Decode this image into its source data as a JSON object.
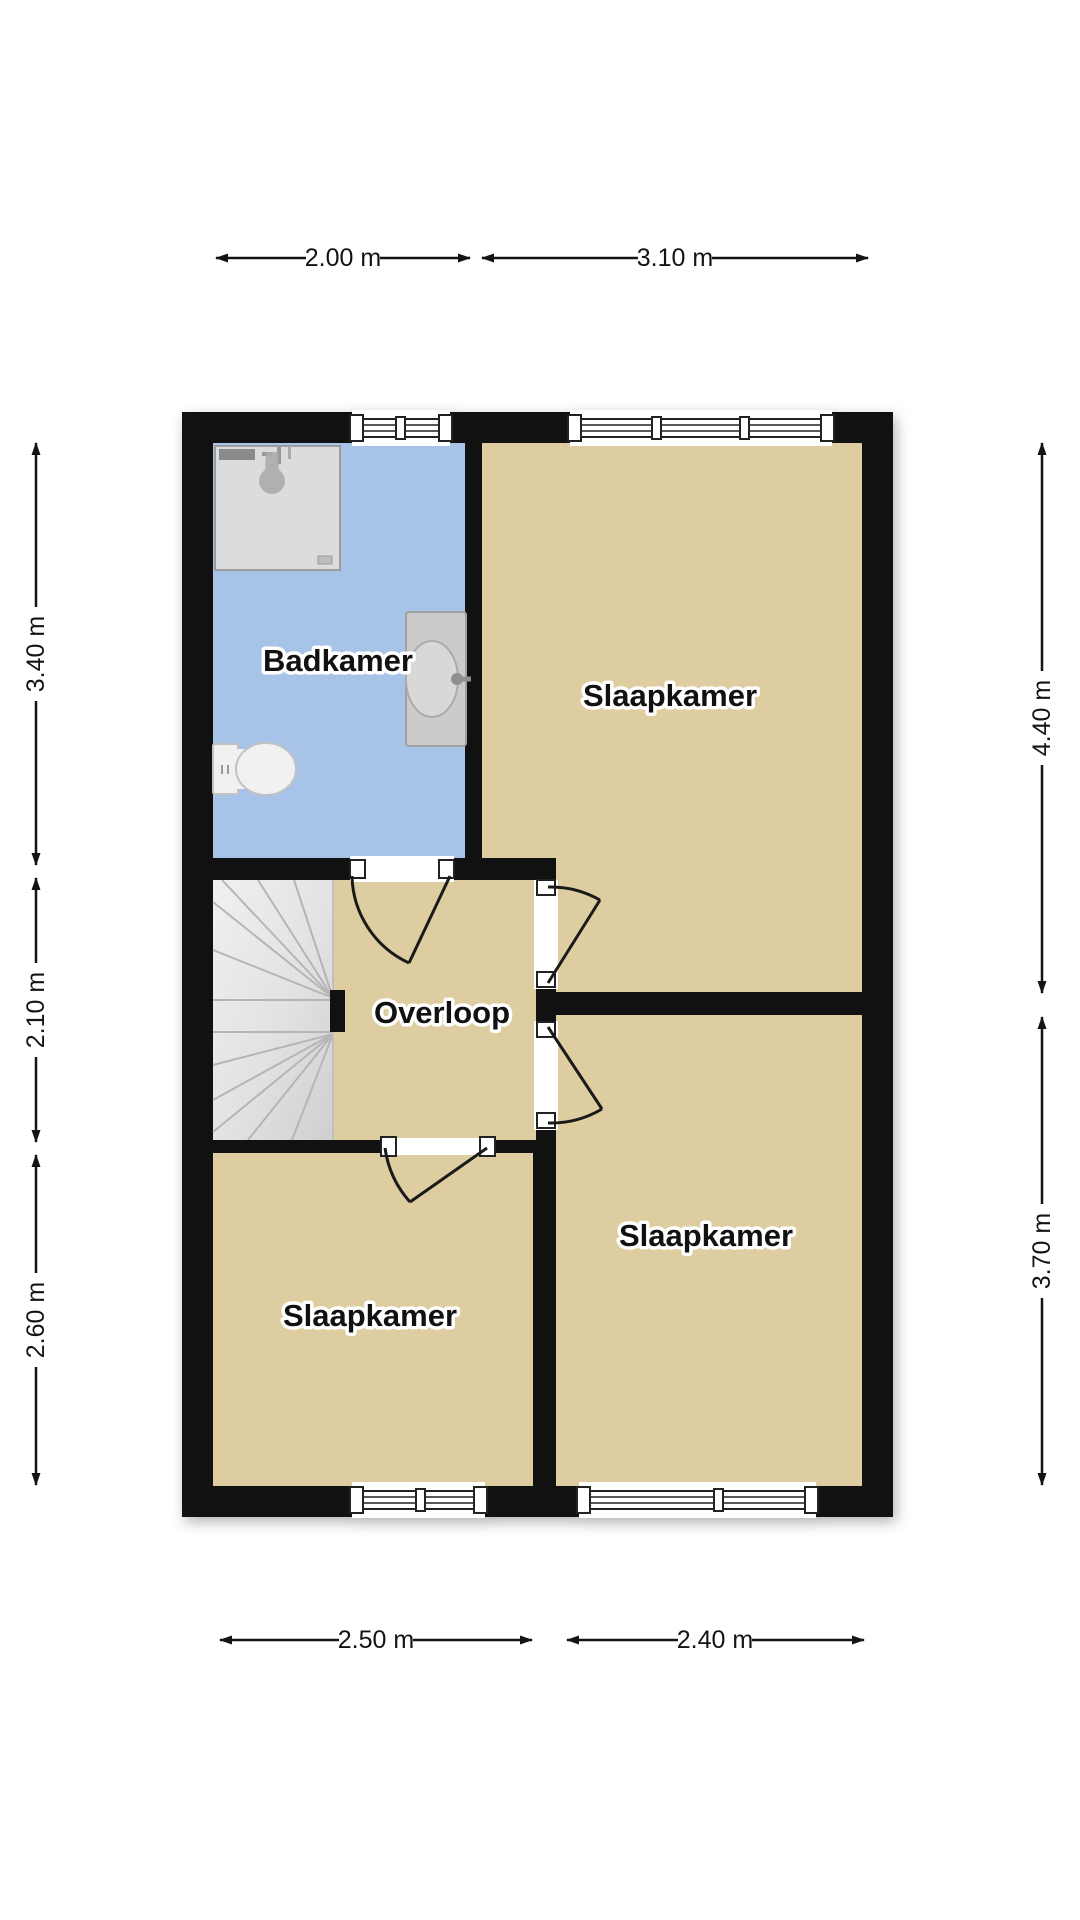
{
  "colors": {
    "wall": "#111111",
    "room": "#decda0",
    "bathroom": "#a7c4e8",
    "outside": "#ffffff",
    "dim": "#141414",
    "label": "#111111",
    "halo": "#ffffff"
  },
  "rooms": [
    {
      "id": "badkamer",
      "label": "Badkamer"
    },
    {
      "id": "slaapkamer-top-right",
      "label": "Slaapkamer"
    },
    {
      "id": "overloop",
      "label": "Overloop"
    },
    {
      "id": "slaapkamer-bottom-left",
      "label": "Slaapkamer"
    },
    {
      "id": "slaapkamer-bottom-right",
      "label": "Slaapkamer"
    }
  ],
  "dimensions": {
    "top": [
      {
        "label": "2.00 m"
      },
      {
        "label": "3.10 m"
      }
    ],
    "bottom": [
      {
        "label": "2.50 m"
      },
      {
        "label": "2.40 m"
      }
    ],
    "left": [
      {
        "label": "3.40 m"
      },
      {
        "label": "2.10 m"
      },
      {
        "label": "2.60 m"
      }
    ],
    "right": [
      {
        "label": "4.40 m"
      },
      {
        "label": "3.70 m"
      }
    ]
  }
}
